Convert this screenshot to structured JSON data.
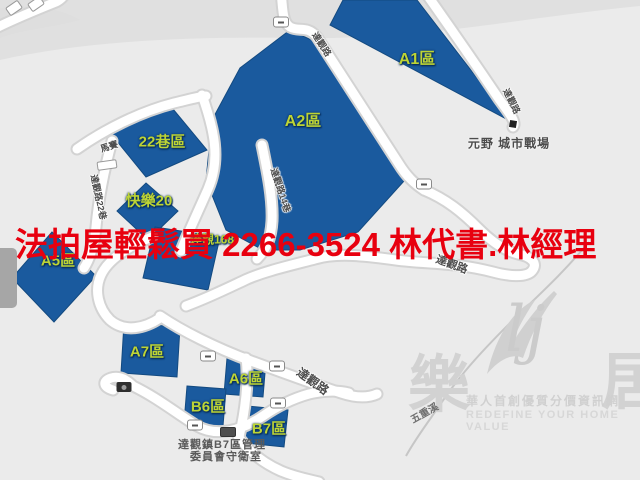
{
  "colors": {
    "background": "#ebebeb",
    "region_fill": "#1a5a9e",
    "region_label": "#bdd435",
    "road_fill": "#ffffff",
    "road_casing": "#d3d3d3",
    "banner_red": "#e8000f",
    "road_label": "#4d4d4d",
    "watermark_gray": "#d2d2d2"
  },
  "banner": {
    "text": "法拍屋輕鬆買 2266-3524  林代書.林經理"
  },
  "map": {
    "regions": [
      {
        "label": "A1區"
      },
      {
        "label": "A2區"
      },
      {
        "label": "22巷區"
      },
      {
        "label": "快樂20"
      },
      {
        "label": "達觀168"
      },
      {
        "label": "A5區"
      },
      {
        "label": "A7區"
      },
      {
        "label": "A6區"
      },
      {
        "label": "B6區"
      },
      {
        "label": "B7區"
      }
    ],
    "road_labels": [
      {
        "text": "達觀路"
      },
      {
        "text": "達觀路"
      },
      {
        "text": "達觀路14巷"
      },
      {
        "text": "達觀路22巷"
      },
      {
        "text": "馬賽"
      },
      {
        "text": "達觀路"
      },
      {
        "text": "達觀路"
      }
    ],
    "pois": {
      "yuanye": {
        "text": "元野 城市戰場"
      },
      "guardhouse": {
        "line1": "達觀鎮B7區管理",
        "line2": "委員會守衛室"
      },
      "river": {
        "text": "五重溪"
      }
    }
  },
  "watermark": {
    "char_left": "樂",
    "char_right": "居",
    "script": "lj",
    "tagline_zh": "華人首創優質分價資訊網",
    "tagline_en": "REDEFINE YOUR HOME VALUE"
  }
}
